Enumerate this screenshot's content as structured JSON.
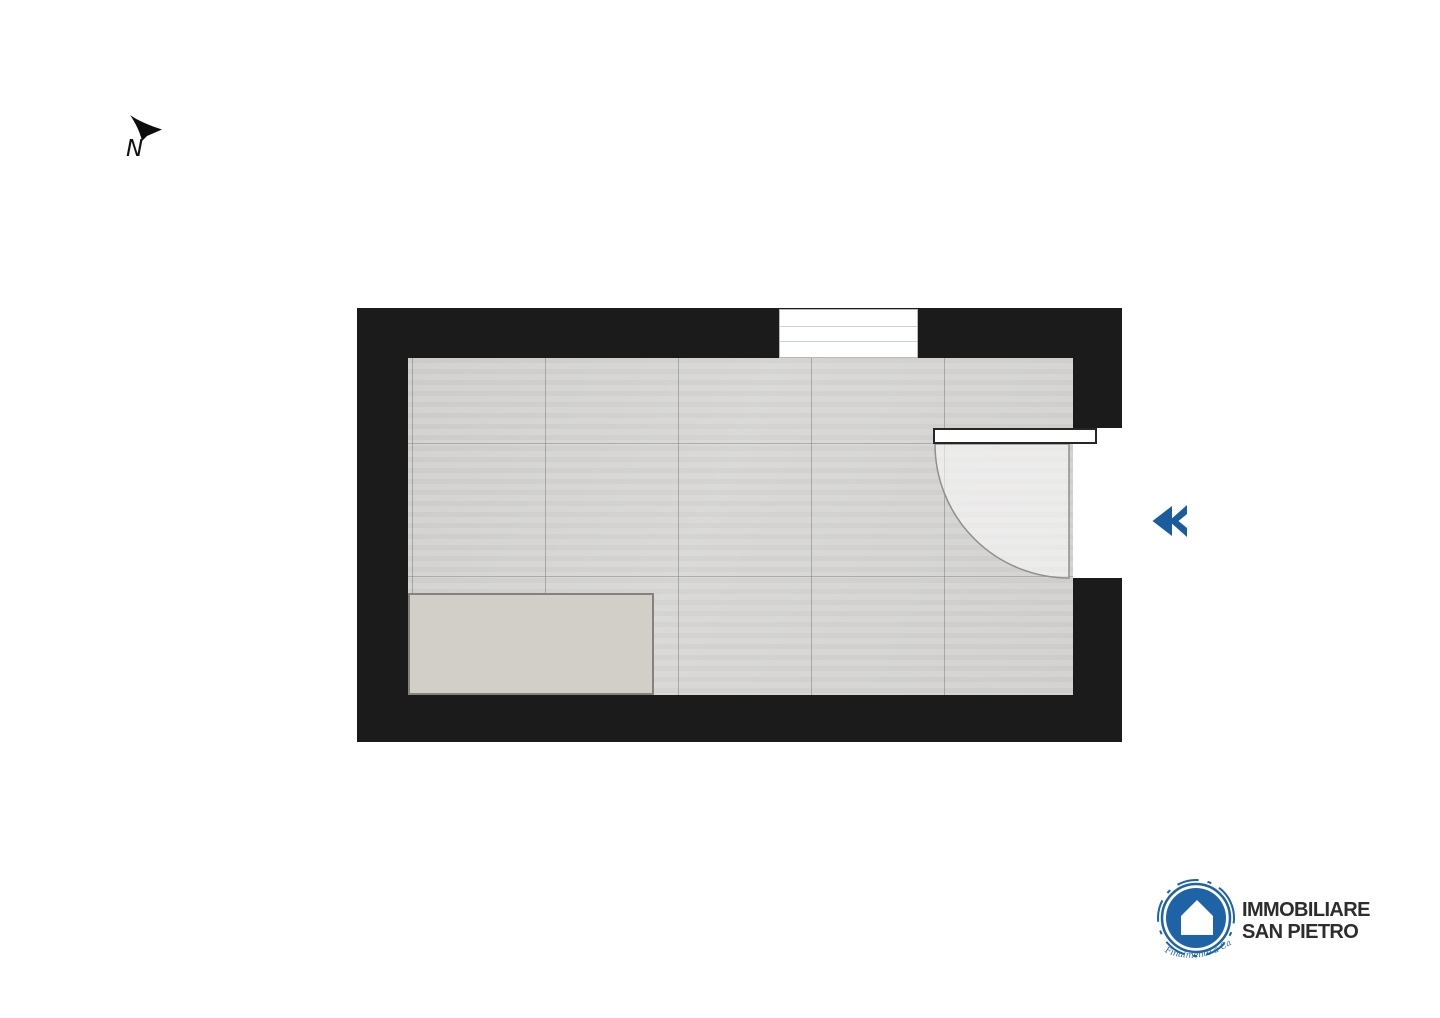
{
  "colors": {
    "wall": "#1b1b1b",
    "floor": "#d8d7d5",
    "floor_seam": "#9a9a98",
    "furniture": "#d2cfc9",
    "accent_blue": "#1b5c9e",
    "logo_blue": "#1e63a5",
    "text_dark": "#2d2d2d"
  },
  "compass": {
    "label": "N"
  },
  "floor_plan": {
    "type": "single-room plan, top view",
    "features": [
      {
        "name": "window",
        "wall": "top",
        "style": "white box with two pane lines"
      },
      {
        "name": "door",
        "wall": "right",
        "swing": "quarter-arc opening into room"
      },
      {
        "name": "furniture-block",
        "position": "bottom-left",
        "style": "plain gray rectangle"
      }
    ]
  },
  "carousel": {
    "prev_icon": "double-chevron-left"
  },
  "logo": {
    "icon": "house-in-blue-circle",
    "name_line1": "IMMOBILIARE",
    "name_line2": "SAN PIETRO",
    "tagline": "Finalmente a Casa"
  }
}
